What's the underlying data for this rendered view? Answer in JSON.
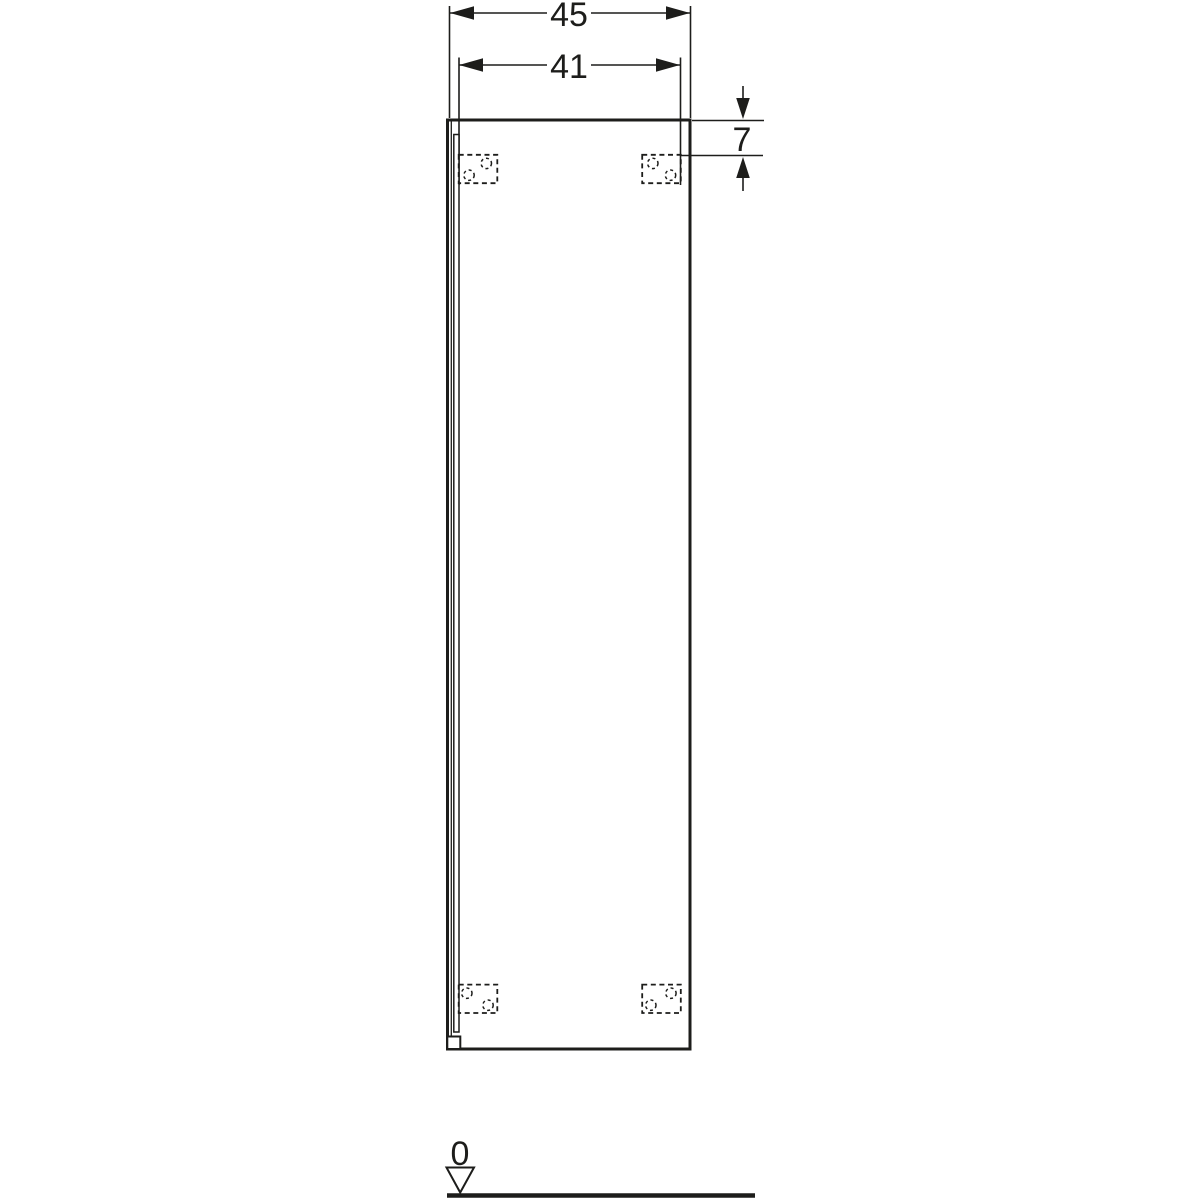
{
  "colors": {
    "line": "#1d1d1b",
    "background": "#ffffff"
  },
  "dimensions": {
    "total_width": "45",
    "mount_spacing": "41",
    "top_offset": "7",
    "floor_datum": "0"
  }
}
